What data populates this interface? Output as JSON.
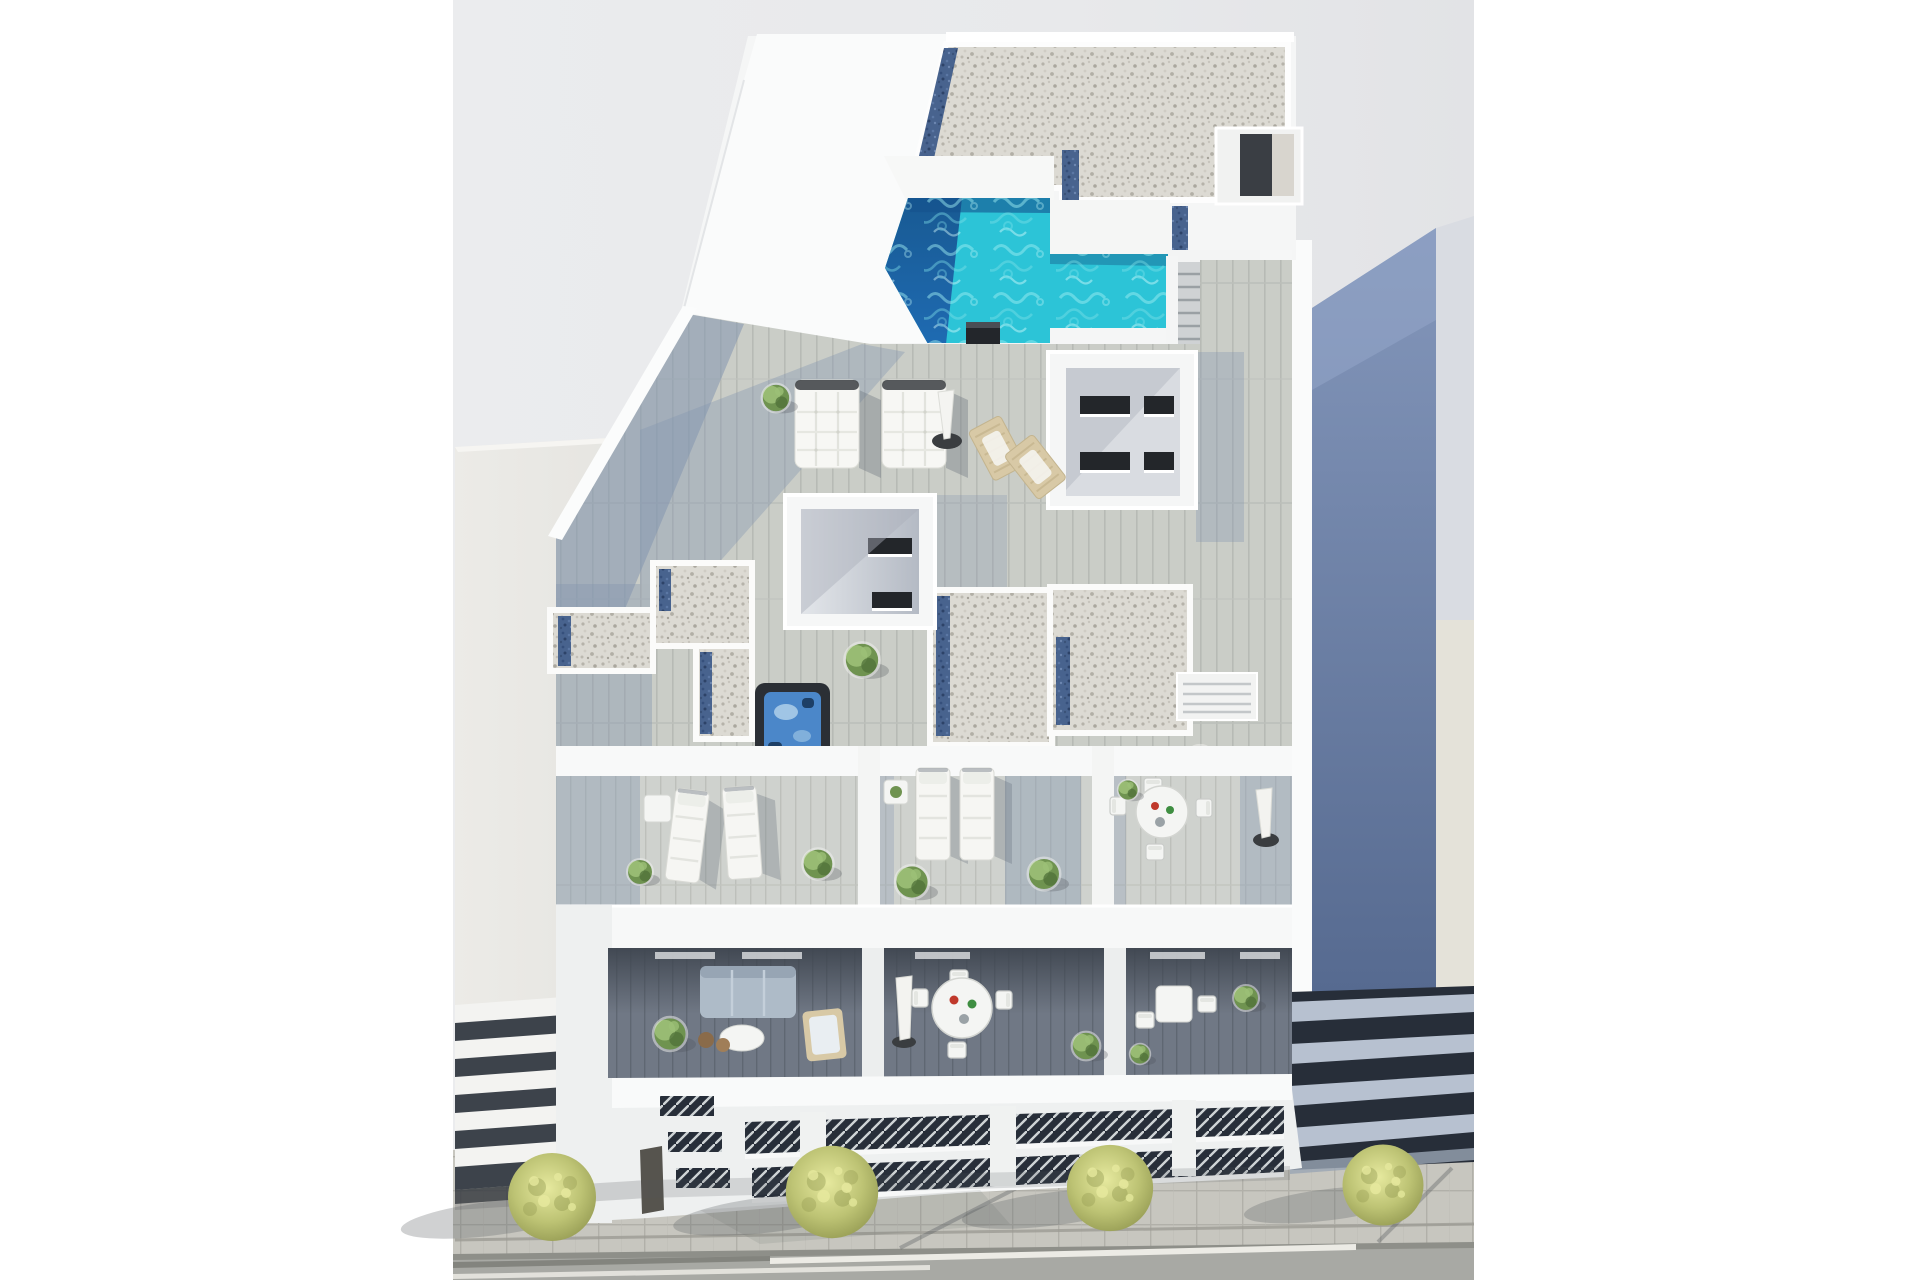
{
  "scene": {
    "title": "Aerial 3D architectural rendering of a modern white apartment building rooftop with L-shaped turquoise pool, jacuzzi, wood deck terraces, sun loungers, balconies with outdoor furniture, flanked by neighbor buildings above a tree-lined sidewalk and road",
    "type": "architectural-render",
    "view": "top-down aerial perspective"
  },
  "objects": {
    "rooftop_pool": 1,
    "jacuzzi": 1,
    "double_sun_loungers": 2,
    "single_sun_loungers": 6,
    "wooden_deck_chairs": 2,
    "closed_umbrellas": 3,
    "round_dining_tables": 2,
    "small_tables": 5,
    "sofa": 1,
    "potted_plants": 14,
    "street_trees": 4,
    "stair_flights": 1,
    "roof_access_door": 1,
    "chimney_vent": 1,
    "light_wells": 2,
    "gravel_roof_sections": 4
  },
  "palette": {
    "bg": "#e9eaec",
    "margin": "#ffffff",
    "wall-bright": "#fafbfb",
    "wall-soft": "#eef0f0",
    "wall-shade": "#e3e6e9",
    "gravel-base": "#dcdad3",
    "gravel-blue": "#48638e",
    "pool-turquoise": "#2cc4d7",
    "pool-deep": "#1b5ea6",
    "pool-strip": "#14518e",
    "deck-light": "#cacdc7",
    "deck-shade": "#8495af",
    "terrace-deck": "#cfd2ce",
    "balcony-floor": "#707885",
    "balcony-shadow": "#3f4650",
    "roof-slate-top": "#8497bb",
    "roof-slate-bottom": "#566a90",
    "roof-edge-light": "#d9dce2",
    "glass-dark": "#272e39",
    "mullion": "#b7c1d0",
    "left-bldg": "#e9e8e4",
    "left-bldg-side": "#dddcd8",
    "slab-white": "#f3f3f1",
    "slab-gap": "#3d434b",
    "sidewalk": "#c7c6bf",
    "paver-line": "#b1b0a9",
    "road": "#a8a9a4",
    "lane-white": "#ecebe5",
    "tree-light": "#e6e99e",
    "tree-mid": "#bdc374",
    "tree-dark": "#8f954e",
    "shadow": "#55585c",
    "jacuzzi-shell": "#2b2f35",
    "jacuzzi-water": "#4b87c9",
    "wood-chair": "#d8c9a6",
    "sofa": "#aebbc8",
    "plant-mid": "#6f9350",
    "plant-light": "#9cc077",
    "plant-dark": "#4f7038",
    "table-white": "#f4f5f3",
    "chimney": "#23262b"
  }
}
